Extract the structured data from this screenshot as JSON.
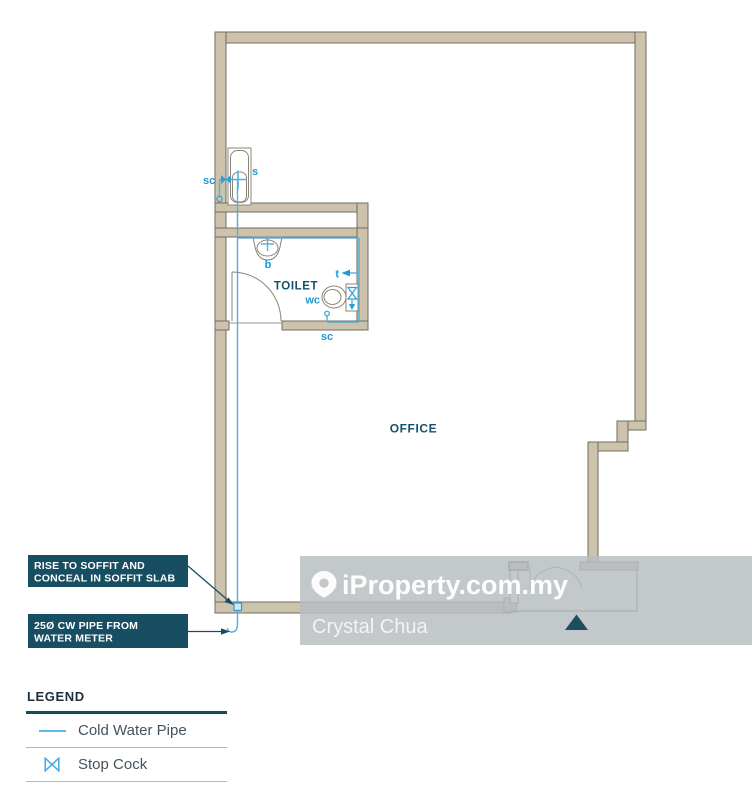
{
  "plan": {
    "room_labels": {
      "toilet": "TOILET",
      "office": "OFFICE"
    },
    "fixture_labels": {
      "stopcock_top": "sc",
      "shower": "s",
      "basin": "b",
      "wc": "wc",
      "tap": "t",
      "stopcock_bottom": "sc"
    }
  },
  "callouts": {
    "rise": {
      "line1": "RISE TO SOFFIT AND",
      "line2": "CONCEAL IN SOFFIT SLAB"
    },
    "pipe": {
      "line1": "25Ø CW PIPE FROM",
      "line2": "WATER METER"
    }
  },
  "watermark": {
    "brand": "iProperty.com.my",
    "agent": "Crystal Chua"
  },
  "legend": {
    "title": "LEGEND",
    "items": [
      {
        "symbol": "cold-water-pipe-line",
        "label": "Cold Water Pipe"
      },
      {
        "symbol": "stop-cock-bowtie",
        "label": "Stop Cock"
      }
    ]
  },
  "colors": {
    "wall": "#cdc3ac",
    "pipe_blue": "#55aede",
    "label_blue": "#1b9ad6",
    "dark_teal": "#14506c",
    "callout_bg": "#174e62",
    "watermark_gray": "#b7bdc1"
  }
}
